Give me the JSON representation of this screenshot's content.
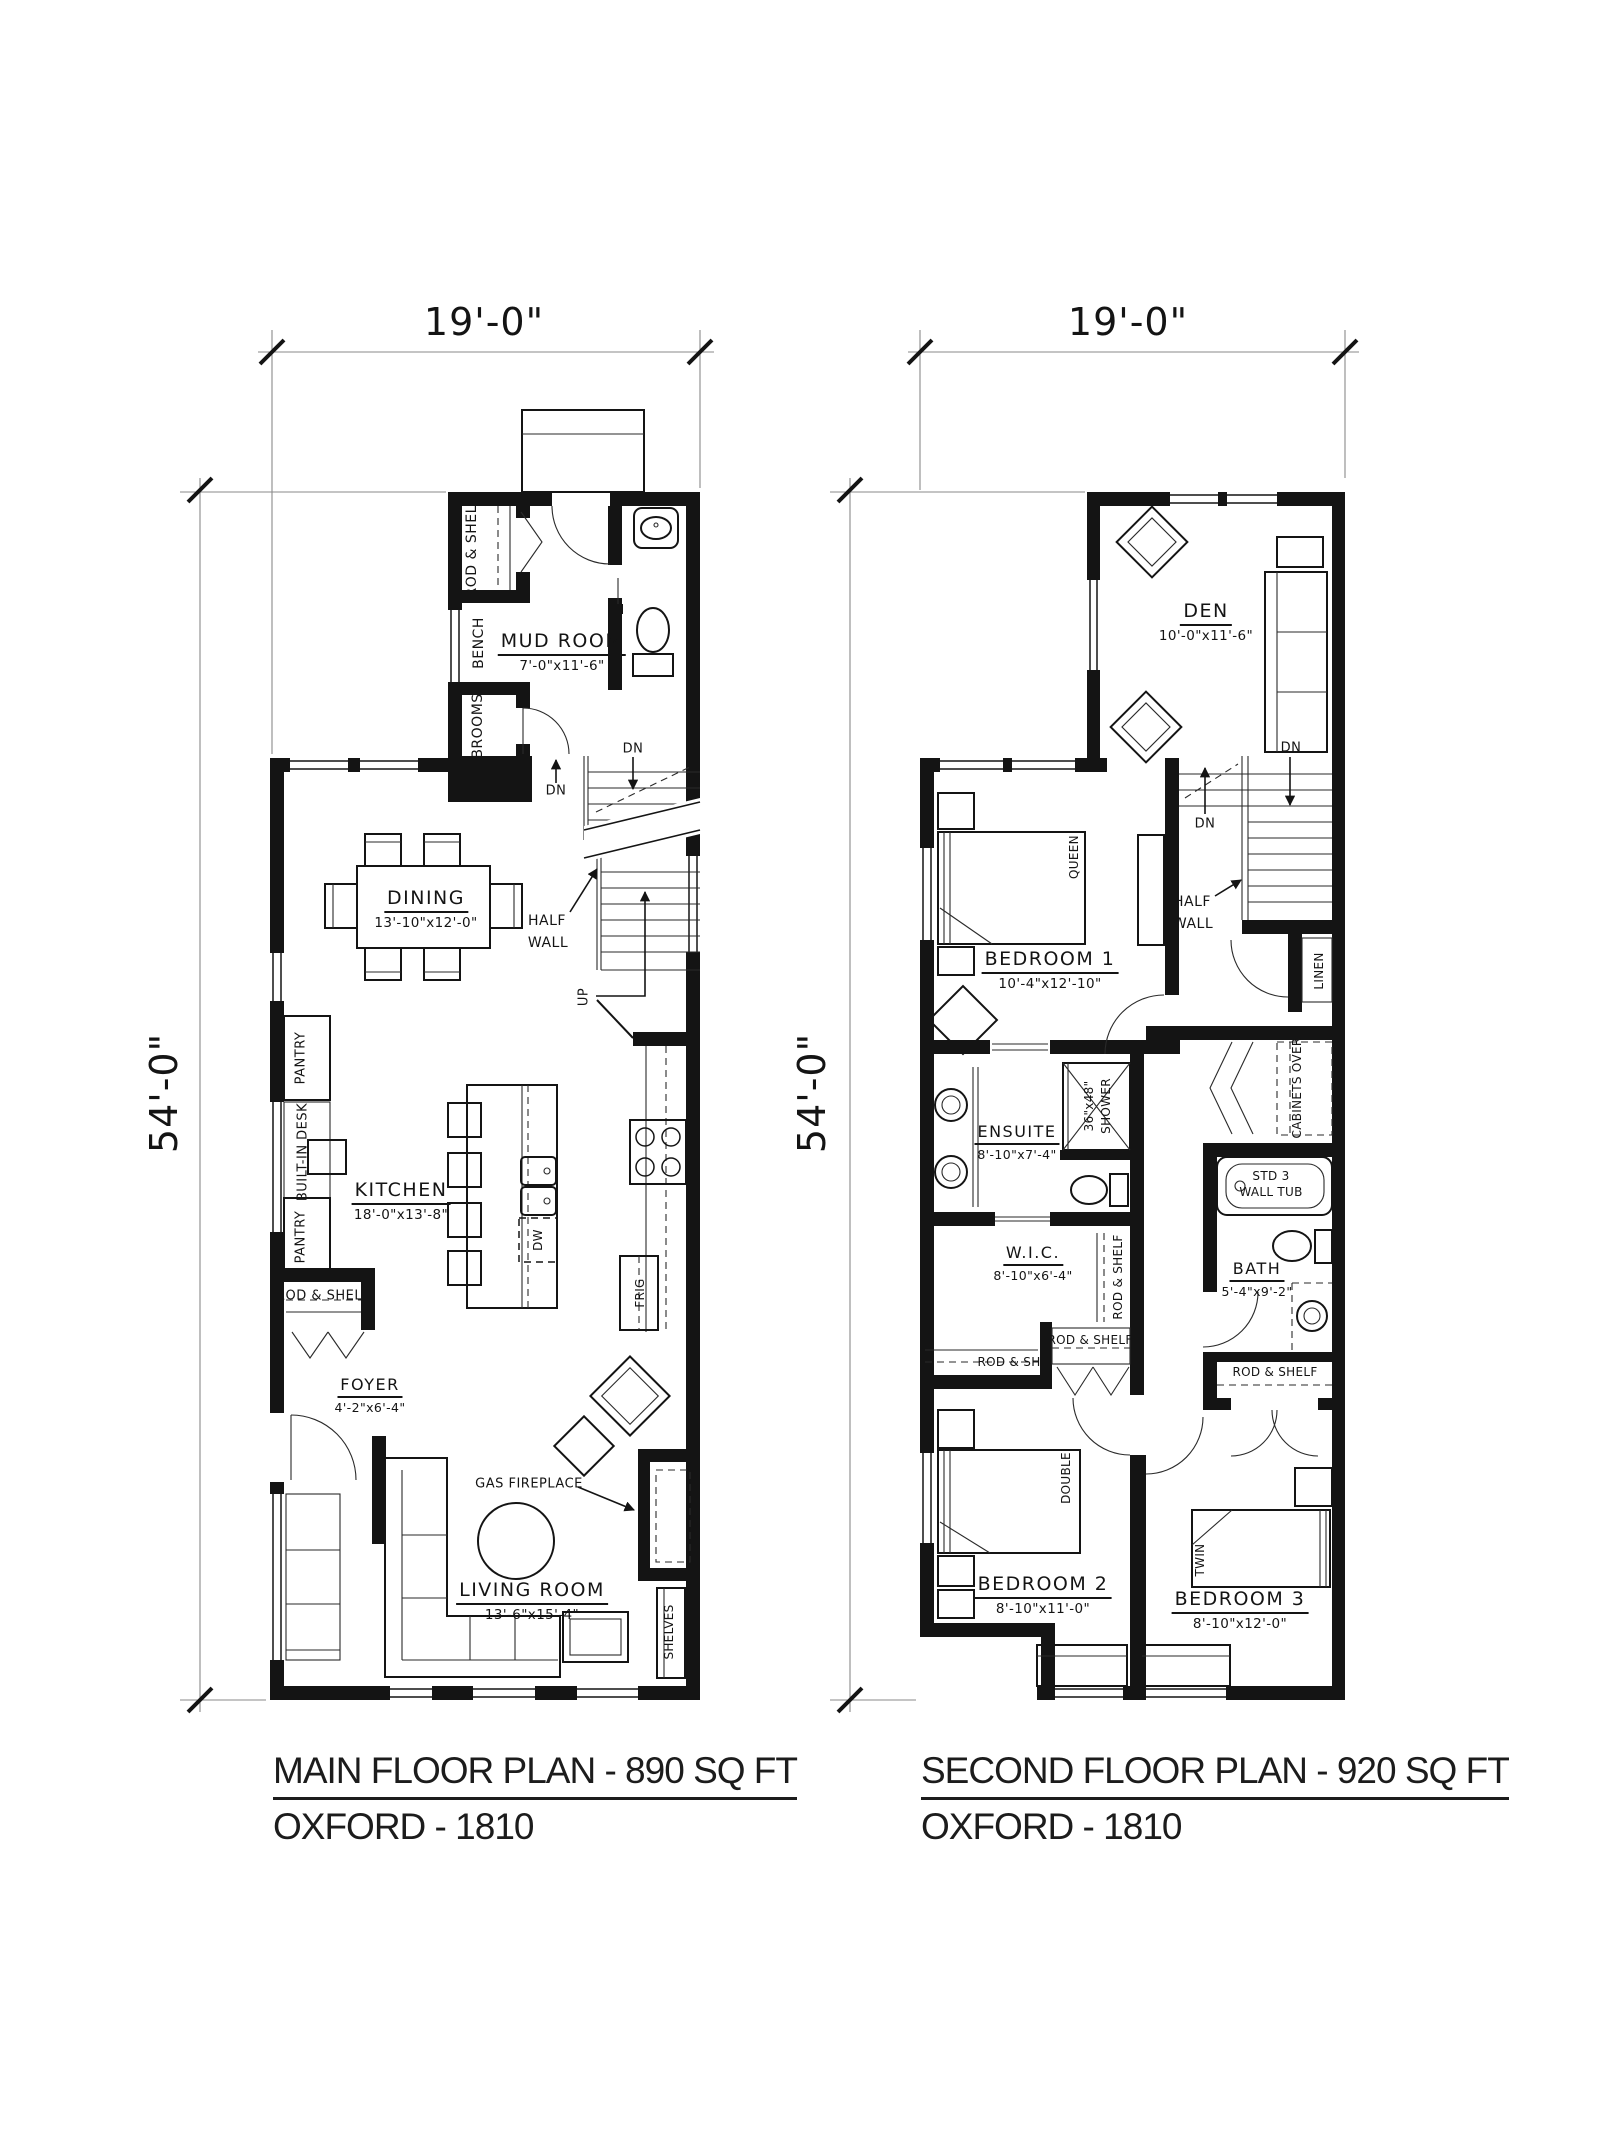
{
  "floor1": {
    "dim_width": "19'-0\"",
    "dim_height": "54'-0\"",
    "rooms": {
      "mud_room": {
        "name": "MUD ROOM",
        "dims": "7'-0\"x11'-6\""
      },
      "dining": {
        "name": "DINING",
        "dims": "13'-10\"x12'-0\""
      },
      "kitchen": {
        "name": "KITCHEN",
        "dims": "18'-0\"x13'-8\""
      },
      "foyer": {
        "name": "FOYER",
        "dims": "4'-2\"x6'-4\""
      },
      "living_room": {
        "name": "LIVING ROOM",
        "dims": "13'-6\"x15'-4\""
      }
    },
    "labels": {
      "rod_shelf_closet": "ROD & SHELF",
      "bench": "BENCH",
      "brooms": "BROOMS",
      "dn_up": "DN",
      "dn_down": "DN",
      "up": "UP",
      "half_wall_1": "HALF",
      "half_wall_2": "WALL",
      "pantry_upper": "PANTRY",
      "built_in_desk": "BUILT-IN DESK",
      "pantry_lower": "PANTRY",
      "dw": "DW",
      "frig": "FRIG",
      "rod_shelf_foyer": "ROD & SHELF",
      "g_fireplace": "GAS FIREPLACE",
      "shelves": "SHELVES"
    },
    "title": "MAIN FLOOR PLAN - 890 SQ FT",
    "subtitle": "OXFORD - 1810"
  },
  "floor2": {
    "dim_width": "19'-0\"",
    "dim_height": "54'-0\"",
    "rooms": {
      "den": {
        "name": "DEN",
        "dims": "10'-0\"x11'-6\""
      },
      "bedroom1": {
        "name": "BEDROOM 1",
        "dims": "10'-4\"x12'-10\""
      },
      "ensuite": {
        "name": "ENSUITE",
        "dims": "8'-10\"x7'-4\""
      },
      "wic": {
        "name": "W.I.C.",
        "dims": "8'-10\"x6'-4\""
      },
      "bath": {
        "name": "BATH",
        "dims": "5'-4\"x9'-2\""
      },
      "bedroom2": {
        "name": "BEDROOM 2",
        "dims": "8'-10\"x11'-0\""
      },
      "bedroom3": {
        "name": "BEDROOM 3",
        "dims": "8'-10\"x12'-0\""
      }
    },
    "labels": {
      "dn_up": "DN",
      "dn_down": "DN",
      "half_wall_1": "HALF",
      "half_wall_2": "WALL",
      "queen": "QUEEN",
      "double": "DOUBLE",
      "twin": "TWIN",
      "linen": "LINEN",
      "shower_size": "36\"x48\"",
      "shower": "SHOWER",
      "cabinets_over": "CABINETS OVER",
      "tub_1": "STD 3",
      "tub_2": "WALL TUB",
      "rod_shelf_wic": "ROD & SHELF",
      "rod_shelf_wic_low": "ROD & SHELF",
      "rod_sh": "ROD & SH",
      "rod_shelf_bed3": "ROD & SHELF"
    },
    "title": "SECOND FLOOR PLAN - 920 SQ FT",
    "subtitle": "OXFORD - 1810"
  }
}
